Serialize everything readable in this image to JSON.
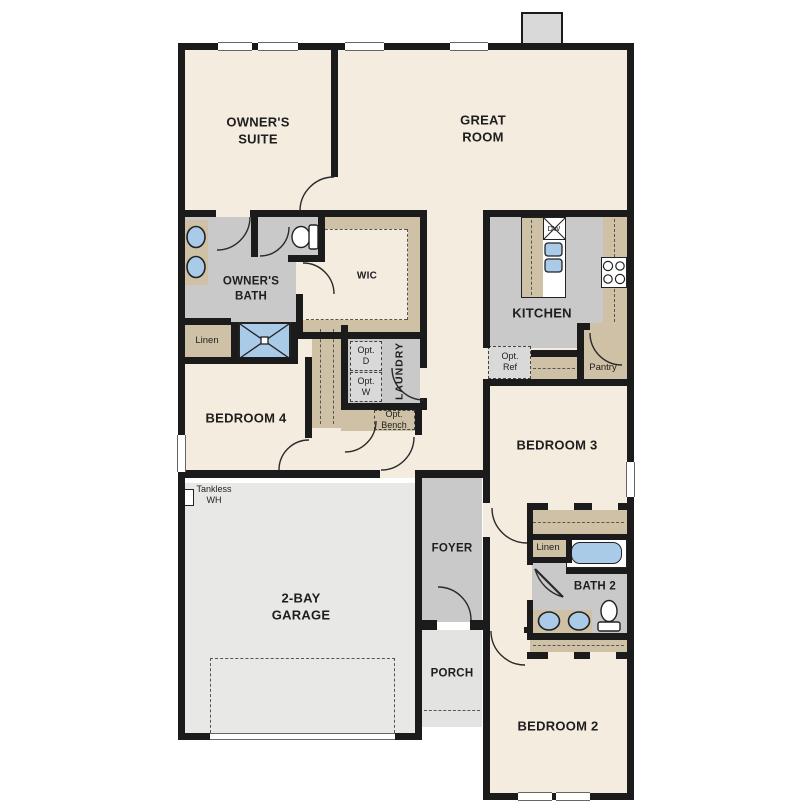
{
  "rooms": {
    "owners_suite": "OWNER'S\nSUITE",
    "great_room": "GREAT\nROOM",
    "owners_bath": "OWNER'S\nBATH",
    "wic": "WIC",
    "kitchen": "KITCHEN",
    "bedroom_4": "BEDROOM 4",
    "laundry": "LAUNDRY",
    "bedroom_3": "BEDROOM 3",
    "garage": "2-BAY\nGARAGE",
    "foyer": "FOYER",
    "porch": "PORCH",
    "bath_2": "BATH 2",
    "bedroom_2": "BEDROOM 2"
  },
  "features": {
    "linen_owners": "Linen",
    "linen_bath2": "Linen",
    "pantry": "Pantry",
    "opt_ref": "Opt.\nRef",
    "opt_d": "Opt.\nD",
    "opt_w": "Opt.\nW",
    "opt_bench": "Opt.\nBench",
    "tankless_wh": "Tankless\nWH",
    "dishwasher": "DW"
  },
  "colors": {
    "wall": "#1b1b1b",
    "room": "#f4ecdf",
    "wet": "#c9c9c9",
    "tan": "#cfc1a5",
    "garage": "#e8e8e6",
    "porch": "#e3e3e1",
    "fixture_blue": "#a9cbe7",
    "optbox": "#d9d9d9",
    "line": "#333333"
  }
}
